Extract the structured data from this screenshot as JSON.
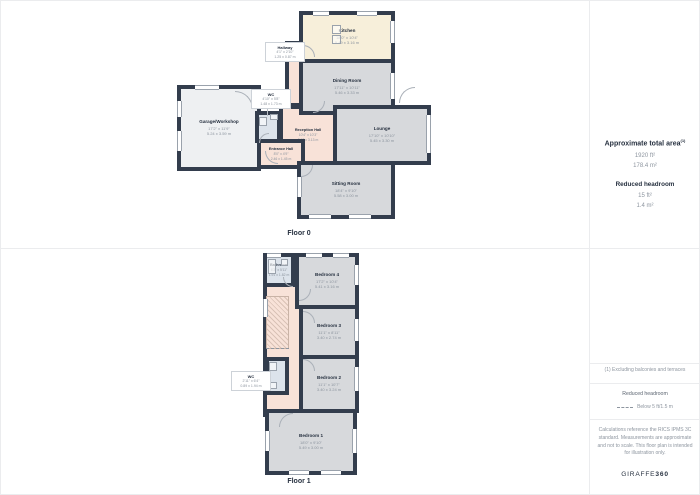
{
  "floors": [
    {
      "label": "Floor 0",
      "rooms": [
        {
          "name": "Kitchen",
          "imperial": "18'0\" x 10'4\"",
          "metric": "5.49 x 3.16 m"
        },
        {
          "name": "Dining Room",
          "imperial": "17'11\" x 10'11\"",
          "metric": "5.46 x 3.33 m"
        },
        {
          "name": "Lounge",
          "imperial": "17'10\" x 10'10\"",
          "metric": "5.45 x 3.30 m"
        },
        {
          "name": "Sitting Room",
          "imperial": "18'4\" x 9'10\"",
          "metric": "5.58 x 3.00 m"
        },
        {
          "name": "Reception Hall",
          "imperial": "10'4\" x 10'3\"",
          "metric": "3.17 x 3.13 m"
        },
        {
          "name": "Entrance Hall",
          "imperial": "8'0\" x 4'9\"",
          "metric": "2.46 x 1.45 m"
        },
        {
          "name": "Garage/Workshop",
          "imperial": "17'2\" x 11'9\"",
          "metric": "5.24 x 3.59 m"
        },
        {
          "name": "WC",
          "imperial": "4'10\" x 5'8\"",
          "metric": "1.48 x 1.73 m"
        },
        {
          "name": "Hallway",
          "imperial": "4'1\" x 2'10\"",
          "metric": "1.25 x 0.87 m"
        }
      ]
    },
    {
      "label": "Floor 1",
      "rooms": [
        {
          "name": "Bathroom",
          "imperial": "6'3\" x 5'11\"",
          "metric": "1.91 x 1.82 m"
        },
        {
          "name": "Bedroom 4",
          "imperial": "17'2\" x 10'4\"",
          "metric": "5.41 x 3.16 m"
        },
        {
          "name": "Bedroom 3",
          "imperial": "11'1\" x 8'11\"",
          "metric": "3.40 x 2.74 m"
        },
        {
          "name": "Bedroom 2",
          "imperial": "11'1\" x 10'7\"",
          "metric": "3.40 x 3.24 m"
        },
        {
          "name": "Bedroom 1",
          "imperial": "18'0\" x 9'10\"",
          "metric": "5.49 x 3.00 m"
        },
        {
          "name": "WC",
          "imperial": "2'11\" x 6'4\"",
          "metric": "0.89 x 1.94 m"
        }
      ]
    }
  ],
  "sidebar": {
    "total_area_title": "Approximate total area",
    "total_area_sup": "(1)",
    "total_area_ft": "1920 ft²",
    "total_area_m": "178.4 m²",
    "reduced_headroom_title": "Reduced headroom",
    "reduced_headroom_ft": "15 ft²",
    "reduced_headroom_m": "1.4 m²",
    "footnote": "(1) Excluding balconies and terraces",
    "legend_title": "Reduced headroom",
    "legend_label": "Below 5 ft/1.5 m",
    "disclaimer": "Calculations reference the RICS IPMS 3C standard. Measurements are approximate and not to scale. This floor plan is intended for illustration only.",
    "brand": "GIRAFFE",
    "brand_bold": "360"
  },
  "colors": {
    "wall": "#333d4d",
    "room_gray": "#d7d9dc",
    "room_cream": "#f7efda",
    "room_pink": "#f8e2d8",
    "room_blue": "#dce3eb",
    "room_light": "#eef0f2",
    "heading_text": "#273140",
    "muted_text": "#8d959f"
  }
}
